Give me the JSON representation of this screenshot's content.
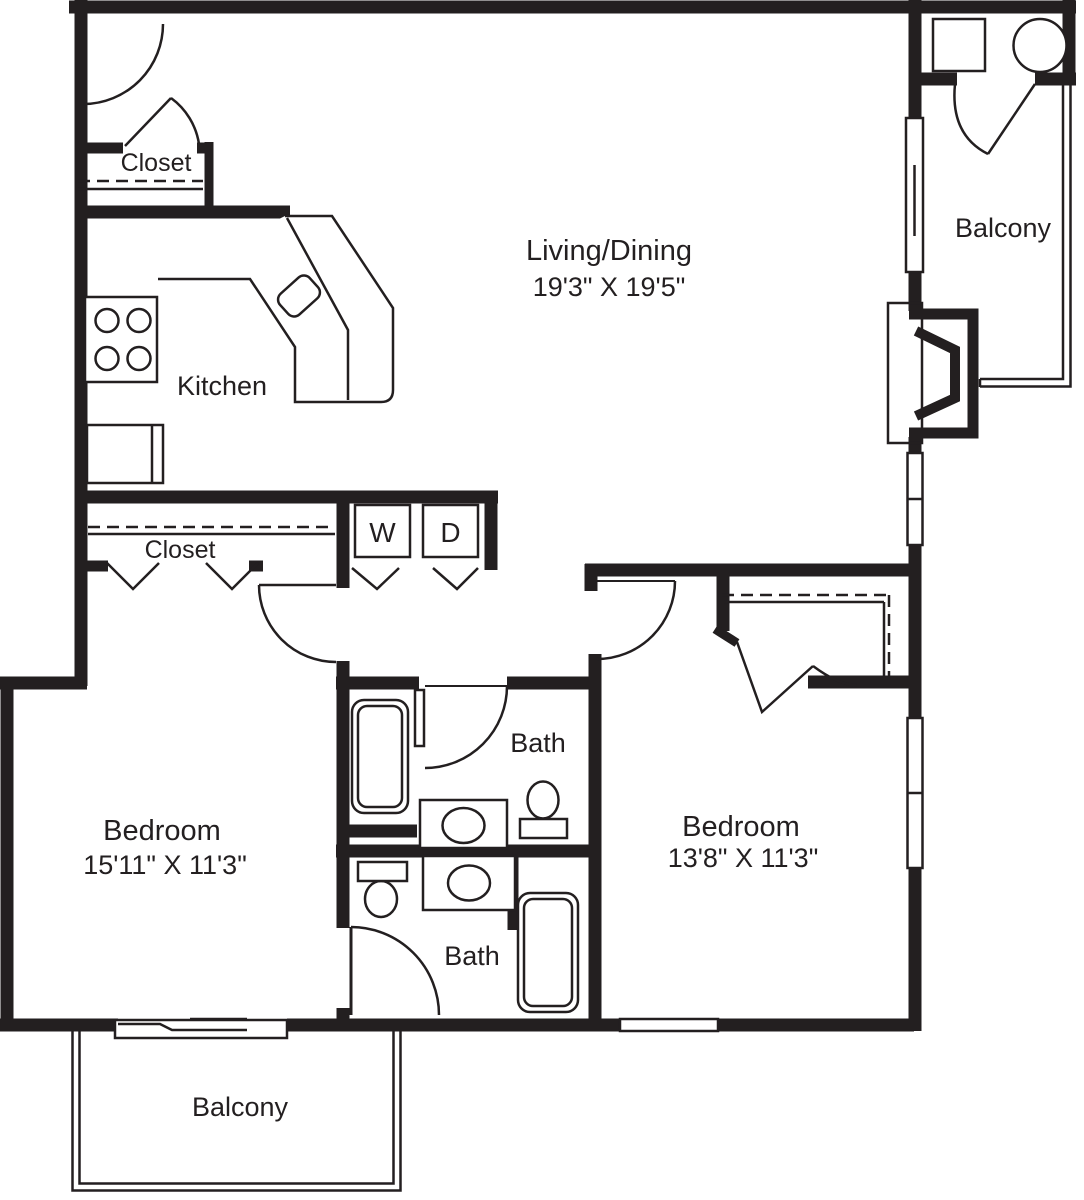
{
  "colors": {
    "line": "#231f20",
    "background": "#ffffff"
  },
  "rooms": {
    "living_dining": {
      "label": "Living/Dining",
      "dimensions": "19'3\" X 19'5\""
    },
    "kitchen": {
      "label": "Kitchen"
    },
    "entry_closet": {
      "label": "Closet"
    },
    "hall_closet": {
      "label": "Closet"
    },
    "balcony_top": {
      "label": "Balcony"
    },
    "balcony_bottom": {
      "label": "Balcony"
    },
    "bath_upper": {
      "label": "Bath"
    },
    "bath_lower": {
      "label": "Bath"
    },
    "bedroom_left": {
      "label": "Bedroom",
      "dimensions": "15'11\" X 11'3\""
    },
    "bedroom_right": {
      "label": "Bedroom",
      "dimensions": "13'8\" X 11'3\""
    }
  },
  "appliances": {
    "washer": {
      "label": "W"
    },
    "dryer": {
      "label": "D"
    }
  }
}
